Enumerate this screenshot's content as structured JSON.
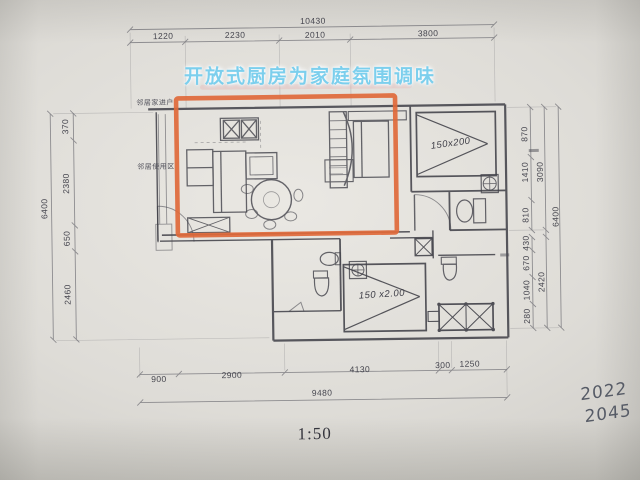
{
  "annotation": {
    "text": "开放式厨房为家庭氛围调味"
  },
  "plan_labels": {
    "neighbor_entry": "邻居家进户",
    "neighbor_zone": "邻居使用区",
    "bed_top_size": "150x200",
    "bed_bottom_size": "150 x2.00"
  },
  "dimensions": {
    "top": {
      "total": "10430",
      "segments": [
        "1220",
        "2230",
        "2010",
        "3800"
      ]
    },
    "bottom": {
      "total": "9480",
      "segments": [
        "900",
        "2900",
        "4130",
        "300",
        "1250"
      ]
    },
    "left": {
      "total": "6400",
      "segments": [
        "370",
        "2380",
        "650",
        "2460"
      ]
    },
    "right": {
      "total": "6400",
      "groups": [
        "3090",
        "2420"
      ],
      "segments": [
        "870",
        "1410",
        "810",
        "430",
        "670",
        "1040",
        "280"
      ]
    }
  },
  "footer": {
    "scale": "1:50"
  },
  "handwriting": {
    "line1": "2022",
    "line2": "2045"
  },
  "colors": {
    "highlight": "#e0693a",
    "annotation_blue": "#7ccfed",
    "pencil": "#3c3c44"
  }
}
